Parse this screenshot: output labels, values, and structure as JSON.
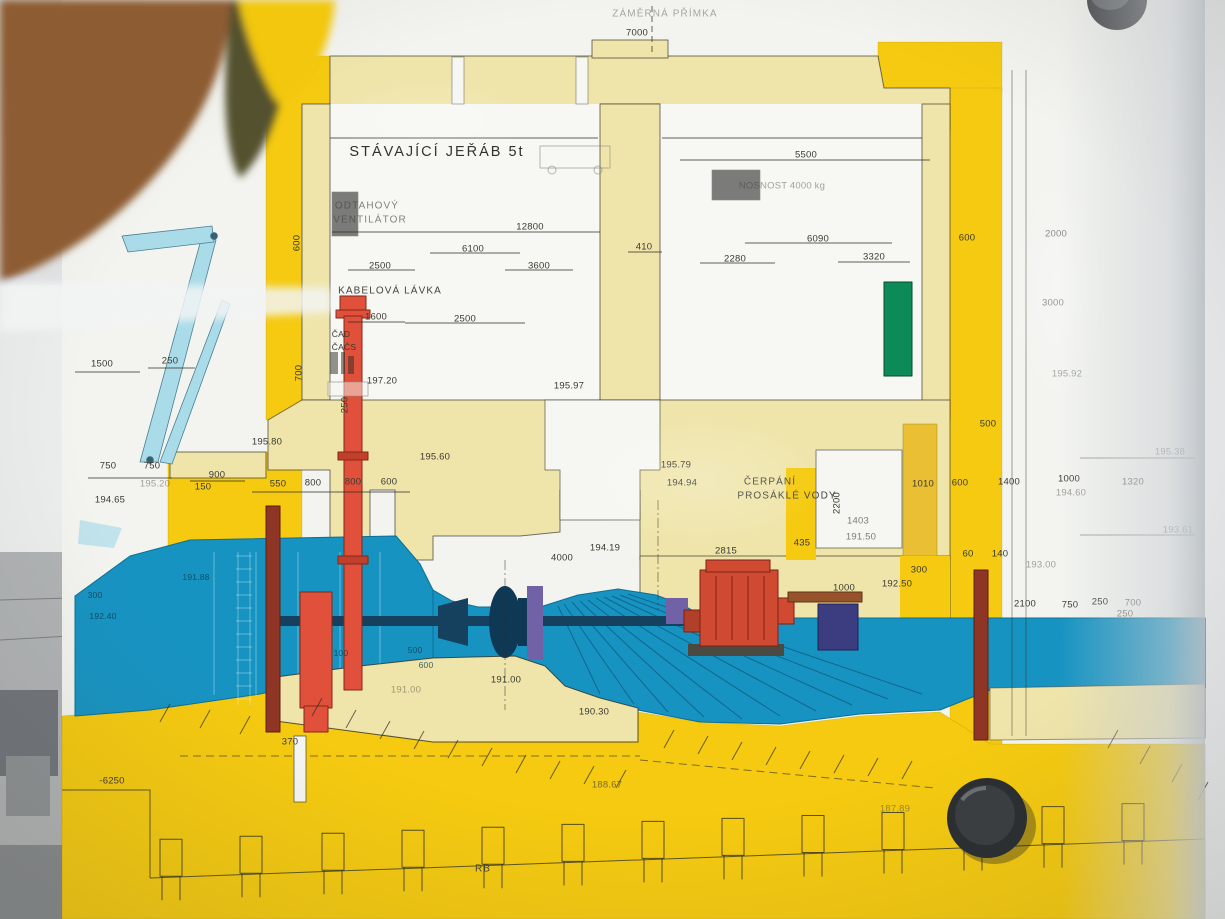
{
  "scene": {
    "subject": "Technical cross-section drawing of a hydro power plant turbine hall, photographed on a notice board",
    "bottom_line_label": "RB"
  },
  "colors": {
    "ground_yellow": "#f5ca10",
    "deep_yellow": "#eabf33",
    "concrete_cream": "#efe5ab",
    "water_blue": "#1793c2",
    "crane_cyan": "#a9dbe9",
    "pipe_red": "#e0503b",
    "stoplog_brown": "#8e3526",
    "generator_red": "#d04a32",
    "cabinet_green": "#0c8a58",
    "machine_navy": "#16415e",
    "purple": "#7162a8",
    "poster_white": "#f3f4f0",
    "interior_white": "#f7f7f3"
  },
  "labels": [
    {
      "t": "ZÁMĚRNÁ PŘÍMKA",
      "x": 665,
      "y": 14,
      "c": "name faint"
    },
    {
      "t": "7000",
      "x": 637,
      "y": 33
    },
    {
      "t": "STÁVAJÍCÍ JEŘÁB 5t",
      "x": 437,
      "y": 152,
      "c": "big"
    },
    {
      "t": "ODTAHOVÝ",
      "x": 367,
      "y": 206,
      "c": "name faint2"
    },
    {
      "t": "VENTILÁTOR",
      "x": 370,
      "y": 220,
      "c": "name faint2"
    },
    {
      "t": "12800",
      "x": 530,
      "y": 227
    },
    {
      "t": "6100",
      "x": 473,
      "y": 249
    },
    {
      "t": "2500",
      "x": 380,
      "y": 266
    },
    {
      "t": "3600",
      "x": 539,
      "y": 266
    },
    {
      "t": "410",
      "x": 644,
      "y": 247
    },
    {
      "t": "KABELOVÁ LÁVKA",
      "x": 390,
      "y": 291,
      "c": "name"
    },
    {
      "t": "1600",
      "x": 376,
      "y": 317
    },
    {
      "t": "2500",
      "x": 465,
      "y": 319
    },
    {
      "t": "ČAD",
      "x": 341,
      "y": 334,
      "c": "sm"
    },
    {
      "t": "ČAČS",
      "x": 344,
      "y": 347,
      "c": "sm"
    },
    {
      "t": "197.20",
      "x": 382,
      "y": 381
    },
    {
      "t": "195.97",
      "x": 569,
      "y": 386
    },
    {
      "t": "5500",
      "x": 806,
      "y": 155
    },
    {
      "t": "NOSNOST 4000 kg",
      "x": 782,
      "y": 186,
      "c": "faint"
    },
    {
      "t": "6090",
      "x": 818,
      "y": 239
    },
    {
      "t": "2280",
      "x": 735,
      "y": 259
    },
    {
      "t": "3320",
      "x": 874,
      "y": 257
    },
    {
      "t": "600",
      "x": 967,
      "y": 238
    },
    {
      "t": "600",
      "x": 297,
      "y": 243,
      "r": -90
    },
    {
      "t": "2000",
      "x": 1056,
      "y": 234,
      "c": "faint2"
    },
    {
      "t": "3000",
      "x": 1053,
      "y": 303,
      "c": "faint2"
    },
    {
      "t": "195.92",
      "x": 1067,
      "y": 374,
      "c": "faint"
    },
    {
      "t": "700",
      "x": 299,
      "y": 373,
      "r": -90
    },
    {
      "t": "250",
      "x": 345,
      "y": 405,
      "r": -90
    },
    {
      "t": "1500",
      "x": 102,
      "y": 364
    },
    {
      "t": "250",
      "x": 170,
      "y": 361
    },
    {
      "t": "750",
      "x": 108,
      "y": 466
    },
    {
      "t": "750",
      "x": 152,
      "y": 466
    },
    {
      "t": "195.80",
      "x": 267,
      "y": 442
    },
    {
      "t": "900",
      "x": 217,
      "y": 475
    },
    {
      "t": "150",
      "x": 203,
      "y": 487
    },
    {
      "t": "195.20",
      "x": 155,
      "y": 484,
      "c": "faint"
    },
    {
      "t": "194.65",
      "x": 110,
      "y": 500
    },
    {
      "t": "550",
      "x": 278,
      "y": 484
    },
    {
      "t": "800",
      "x": 313,
      "y": 483
    },
    {
      "t": "800",
      "x": 353,
      "y": 482
    },
    {
      "t": "600",
      "x": 389,
      "y": 482
    },
    {
      "t": "195.60",
      "x": 435,
      "y": 457
    },
    {
      "t": "195.79",
      "x": 676,
      "y": 465
    },
    {
      "t": "194.94",
      "x": 682,
      "y": 483
    },
    {
      "t": "ČERPÁNÍ",
      "x": 770,
      "y": 482,
      "c": "name"
    },
    {
      "t": "PROSÁKLÉ VODY",
      "x": 787,
      "y": 496,
      "c": "name"
    },
    {
      "t": "2200",
      "x": 837,
      "y": 503,
      "r": -90
    },
    {
      "t": "1403",
      "x": 858,
      "y": 521,
      "c": "faint2"
    },
    {
      "t": "191.50",
      "x": 861,
      "y": 537,
      "c": "faint2"
    },
    {
      "t": "435",
      "x": 802,
      "y": 543
    },
    {
      "t": "2815",
      "x": 726,
      "y": 551
    },
    {
      "t": "4000",
      "x": 562,
      "y": 558
    },
    {
      "t": "194.19",
      "x": 605,
      "y": 548
    },
    {
      "t": "500",
      "x": 988,
      "y": 424
    },
    {
      "t": "1010",
      "x": 923,
      "y": 484
    },
    {
      "t": "600",
      "x": 960,
      "y": 483
    },
    {
      "t": "1400",
      "x": 1009,
      "y": 482
    },
    {
      "t": "1000",
      "x": 1069,
      "y": 479
    },
    {
      "t": "194.60",
      "x": 1071,
      "y": 493,
      "c": "faint"
    },
    {
      "t": "1320",
      "x": 1133,
      "y": 482,
      "c": "faint2"
    },
    {
      "t": "195.38",
      "x": 1170,
      "y": 452,
      "c": "faint"
    },
    {
      "t": "193.61",
      "x": 1178,
      "y": 530,
      "c": "faint"
    },
    {
      "t": "192.50",
      "x": 897,
      "y": 584
    },
    {
      "t": "300",
      "x": 919,
      "y": 570
    },
    {
      "t": "60",
      "x": 968,
      "y": 554
    },
    {
      "t": "140",
      "x": 1000,
      "y": 554
    },
    {
      "t": "193.00",
      "x": 1041,
      "y": 565,
      "c": "faint"
    },
    {
      "t": "2100",
      "x": 1025,
      "y": 604
    },
    {
      "t": "750",
      "x": 1070,
      "y": 605
    },
    {
      "t": "250",
      "x": 1100,
      "y": 602
    },
    {
      "t": "700",
      "x": 1133,
      "y": 603,
      "c": "faint2"
    },
    {
      "t": "250",
      "x": 1125,
      "y": 614,
      "c": "faint2"
    },
    {
      "t": "1000",
      "x": 844,
      "y": 588
    },
    {
      "t": "300",
      "x": 95,
      "y": 595,
      "c": "wdim"
    },
    {
      "t": "192.40",
      "x": 103,
      "y": 616,
      "c": "wdim"
    },
    {
      "t": "191.88",
      "x": 196,
      "y": 577,
      "c": "wdim"
    },
    {
      "t": "100",
      "x": 341,
      "y": 653,
      "c": "wdim"
    },
    {
      "t": "370",
      "x": 290,
      "y": 742
    },
    {
      "t": "500",
      "x": 415,
      "y": 650,
      "c": "wdim"
    },
    {
      "t": "600",
      "x": 426,
      "y": 665,
      "c": "wdim"
    },
    {
      "t": "191.00",
      "x": 406,
      "y": 690,
      "c": "faint"
    },
    {
      "t": "191.00",
      "x": 506,
      "y": 680
    },
    {
      "t": "190.30",
      "x": 594,
      "y": 712
    },
    {
      "t": "188.67",
      "x": 607,
      "y": 785,
      "c": "faint2"
    },
    {
      "t": "187.89",
      "x": 895,
      "y": 809,
      "c": "faint"
    },
    {
      "t": "-6250",
      "x": 112,
      "y": 781
    },
    {
      "t": "RB",
      "x": 483,
      "y": 869,
      "c": "name"
    }
  ]
}
